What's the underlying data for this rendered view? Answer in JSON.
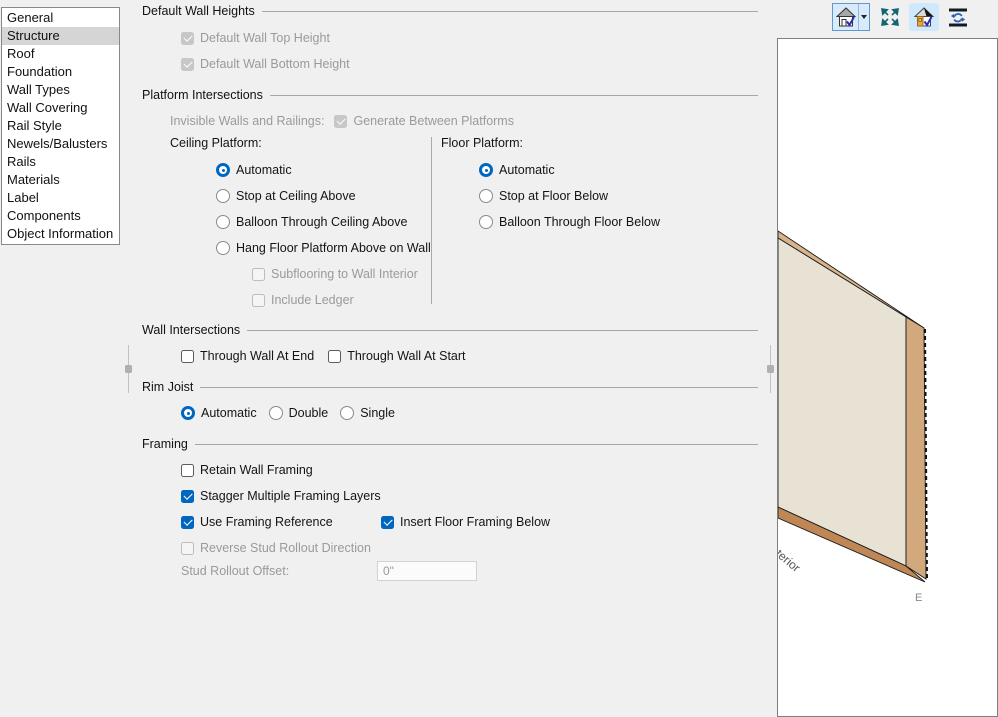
{
  "sidebar": {
    "selected_item": "Structure",
    "items": [
      "General",
      "Structure",
      "Roof",
      "Foundation",
      "Wall Types",
      "Wall Covering",
      "Rail Style",
      "Newels/Balusters",
      "Rails",
      "Materials",
      "Label",
      "Components",
      "Object Information"
    ]
  },
  "toolbar": {
    "buttons": [
      {
        "icon": "house-check-icon",
        "has_dropdown": true,
        "active": true
      },
      {
        "icon": "fill-window-arrows-icon",
        "active": false
      },
      {
        "icon": "house-materials-check-icon",
        "active": true
      },
      {
        "icon": "auto-refresh-bars-icon",
        "active": false
      }
    ]
  },
  "sections": {
    "default_wall_heights": {
      "title": "Default Wall Heights",
      "top_height": "Default Wall Top Height",
      "bottom_height": "Default Wall Bottom Height",
      "top_height_checked": true,
      "bottom_height_checked": true
    },
    "platform_intersections": {
      "title": "Platform Intersections",
      "invisible_walls_label": "Invisible Walls and Railings:",
      "generate_between_platforms": "Generate Between Platforms",
      "generate_checked": true,
      "ceiling_platform": {
        "title": "Ceiling Platform:",
        "automatic": "Automatic",
        "stop": "Stop at Ceiling Above",
        "balloon": "Balloon Through Ceiling Above",
        "hang": "Hang Floor Platform Above on Wall",
        "subflooring": "Subflooring to Wall Interior",
        "ledger": "Include Ledger",
        "selected": "Automatic"
      },
      "floor_platform": {
        "title": "Floor Platform:",
        "automatic": "Automatic",
        "stop": "Stop at Floor Below",
        "balloon": "Balloon Through Floor Below",
        "selected": "Automatic"
      }
    },
    "wall_intersections": {
      "title": "Wall Intersections",
      "through_end": "Through Wall At End",
      "through_start": "Through Wall At Start",
      "through_end_checked": false,
      "through_start_checked": false
    },
    "rim_joist": {
      "title": "Rim Joist",
      "automatic": "Automatic",
      "double": "Double",
      "single": "Single",
      "selected": "Automatic"
    },
    "framing": {
      "title": "Framing",
      "retain": "Retain Wall Framing",
      "retain_checked": false,
      "stagger": "Stagger Multiple Framing Layers",
      "stagger_checked": true,
      "use_reference": "Use Framing Reference",
      "use_reference_checked": true,
      "insert_floor_below": "Insert Floor Framing Below",
      "insert_floor_below_checked": true,
      "reverse_rollout": "Reverse Stud Rollout Direction",
      "reverse_rollout_checked": false,
      "offset_label": "Stud Rollout Offset:",
      "offset_value": "0\""
    }
  },
  "preview": {
    "interior_label": "terior",
    "end_label": "E",
    "wall_face_color": "#e8e2d4",
    "wall_edge_color": "#d9b38c",
    "wall_end_color": "#d2a97c",
    "wall_bottom_color": "#bf8756"
  },
  "colors": {
    "accent": "#0067c0",
    "background": "#f0f0f0",
    "disabled_text": "#9a9a9a",
    "selected_item_bg": "#d5d5d5"
  }
}
